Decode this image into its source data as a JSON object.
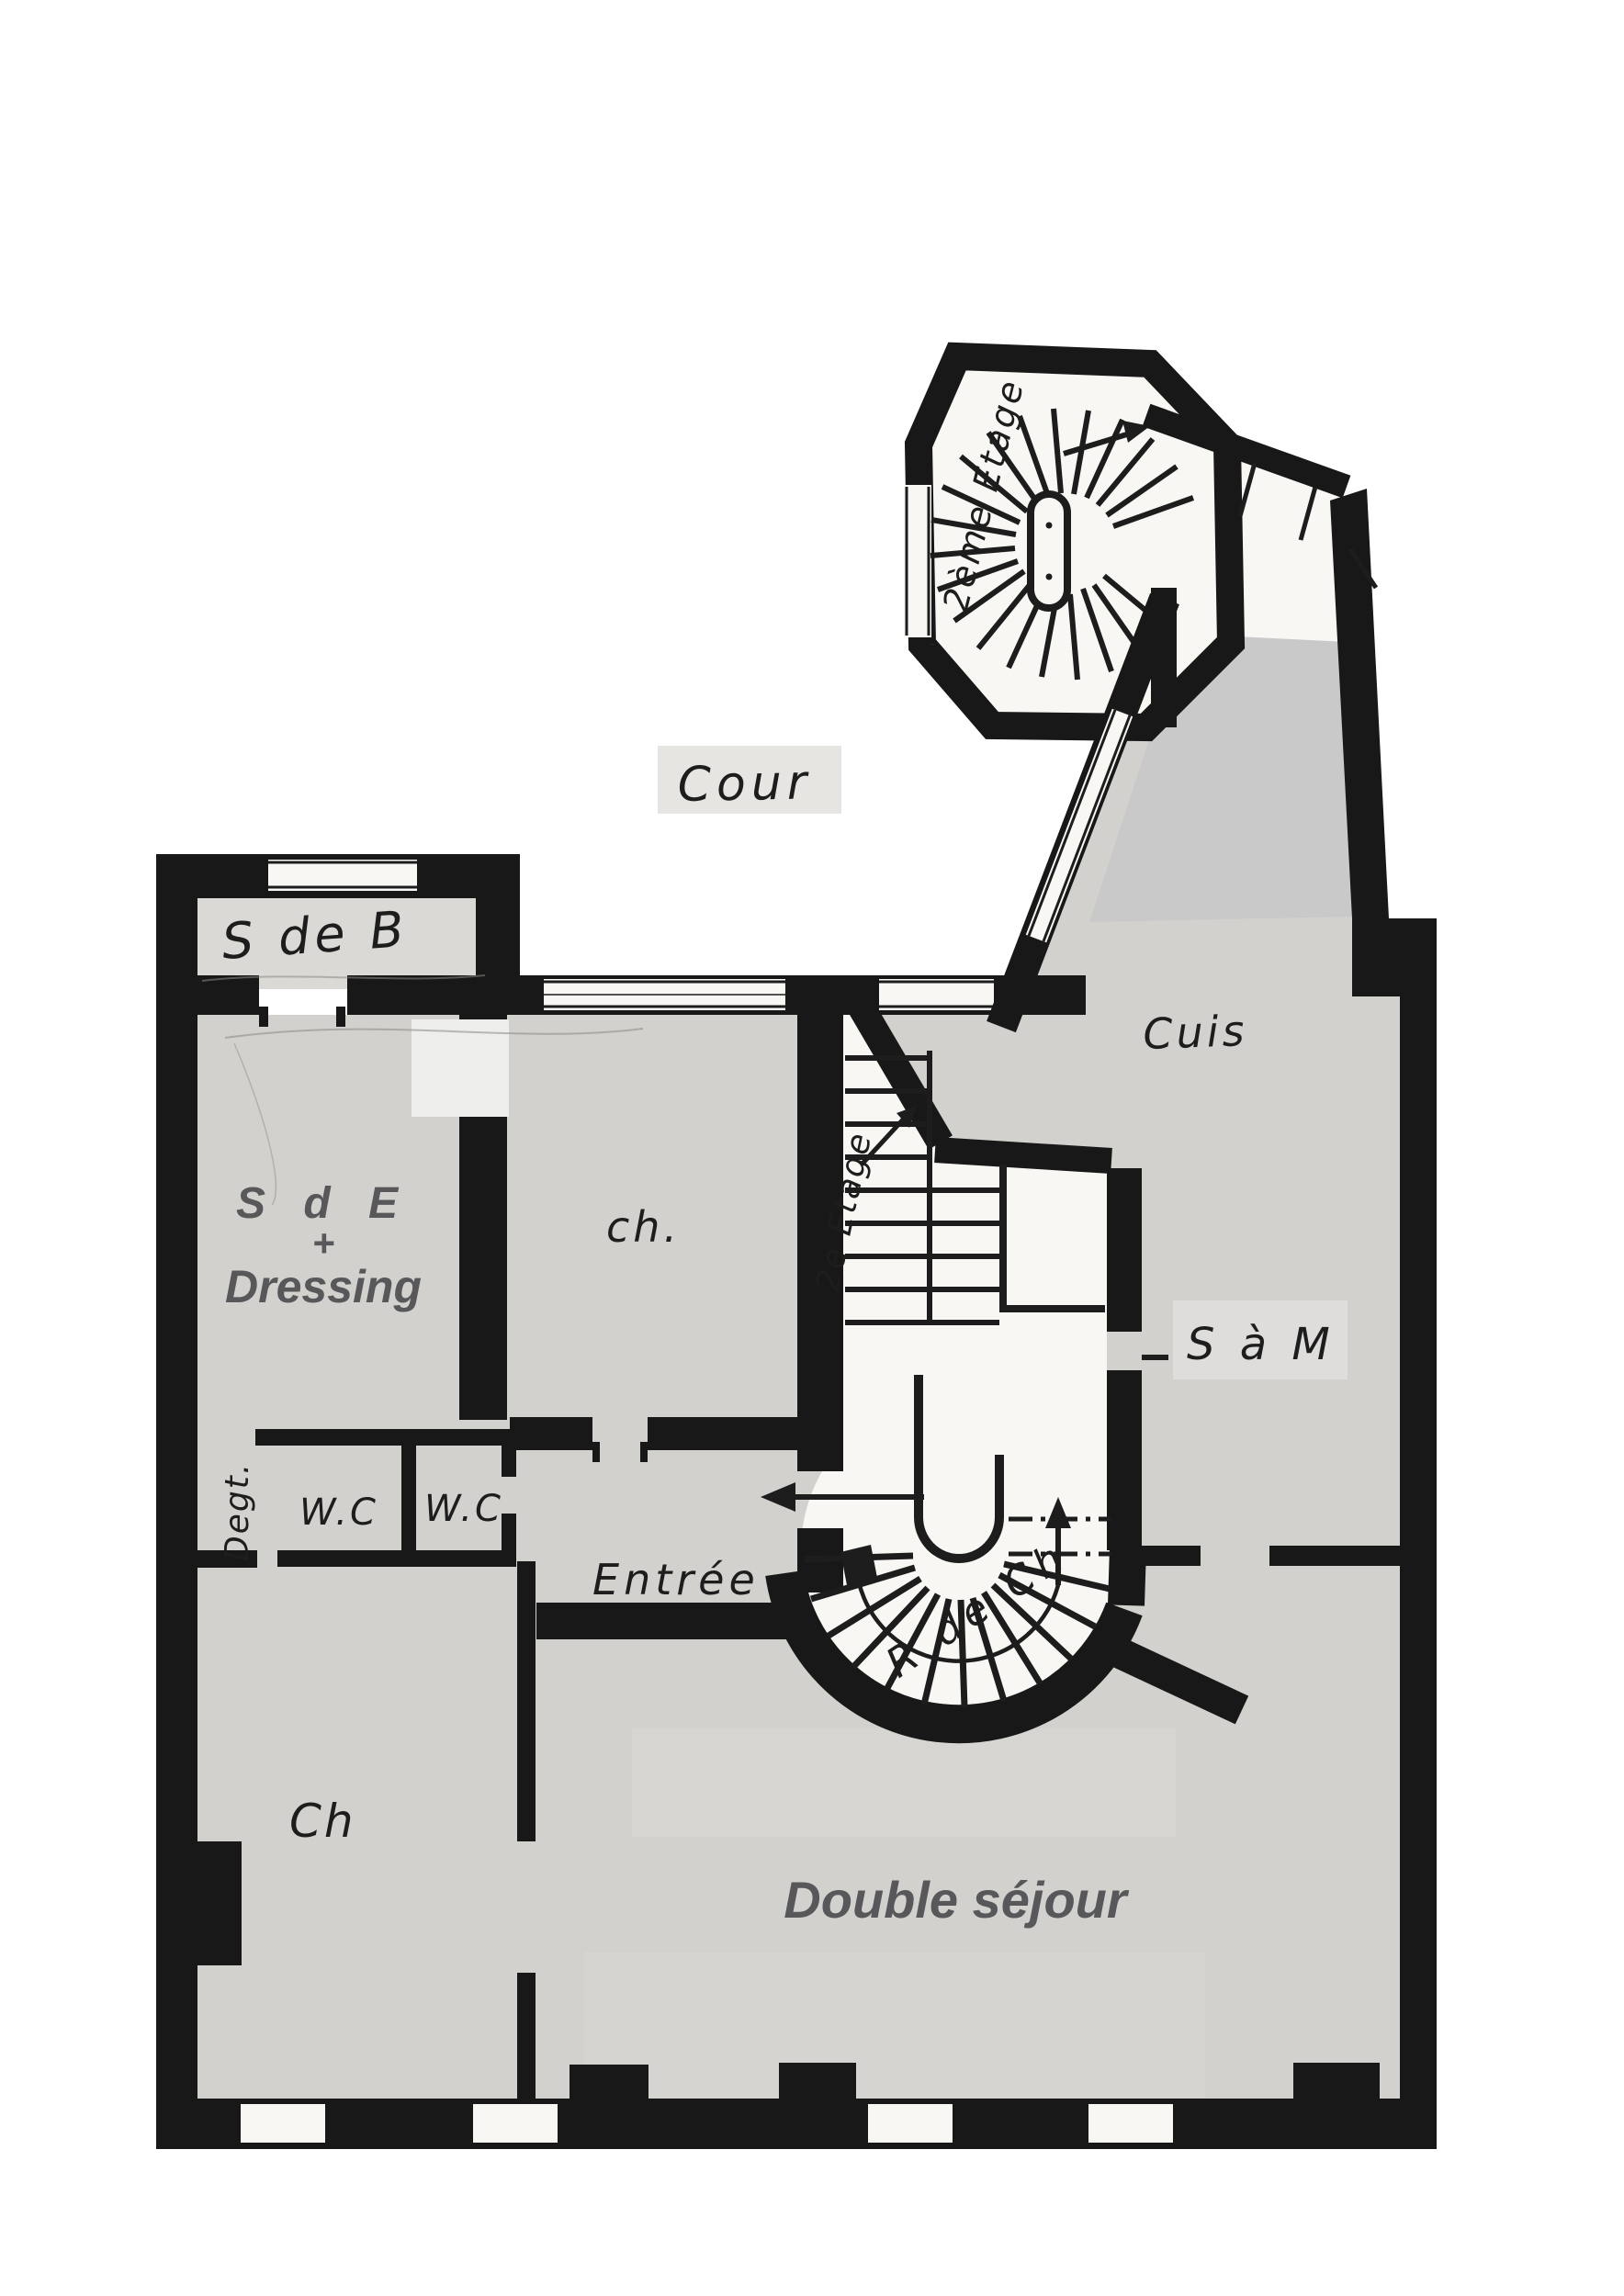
{
  "labels": {
    "cour": "Cour",
    "salle_de_bain": "S de B",
    "sde_line1": "S d E",
    "sde_plus": "+",
    "sde_line2": "Dressing",
    "chambre_middle": "ch.",
    "cuisine": "Cuis",
    "salle_a_manger": "S à M",
    "wc_left": "W.C",
    "wc_right": "W.C",
    "degagement": "Degt.",
    "entree": "Entrée",
    "chambre_bottom": "Ch",
    "double_sejour": "Double séjour",
    "stair_tower": "2ème Etage",
    "stair_mid": "2e Etage",
    "stair_spiral": "R de Ch"
  },
  "colors": {
    "wall": "#181818",
    "room_fill": "#d3d1cd",
    "flat_fill": "#c9c9c9",
    "label_patch": "#e6e5e2",
    "annotation": "#58585a",
    "ink": "#1d1d1d"
  }
}
